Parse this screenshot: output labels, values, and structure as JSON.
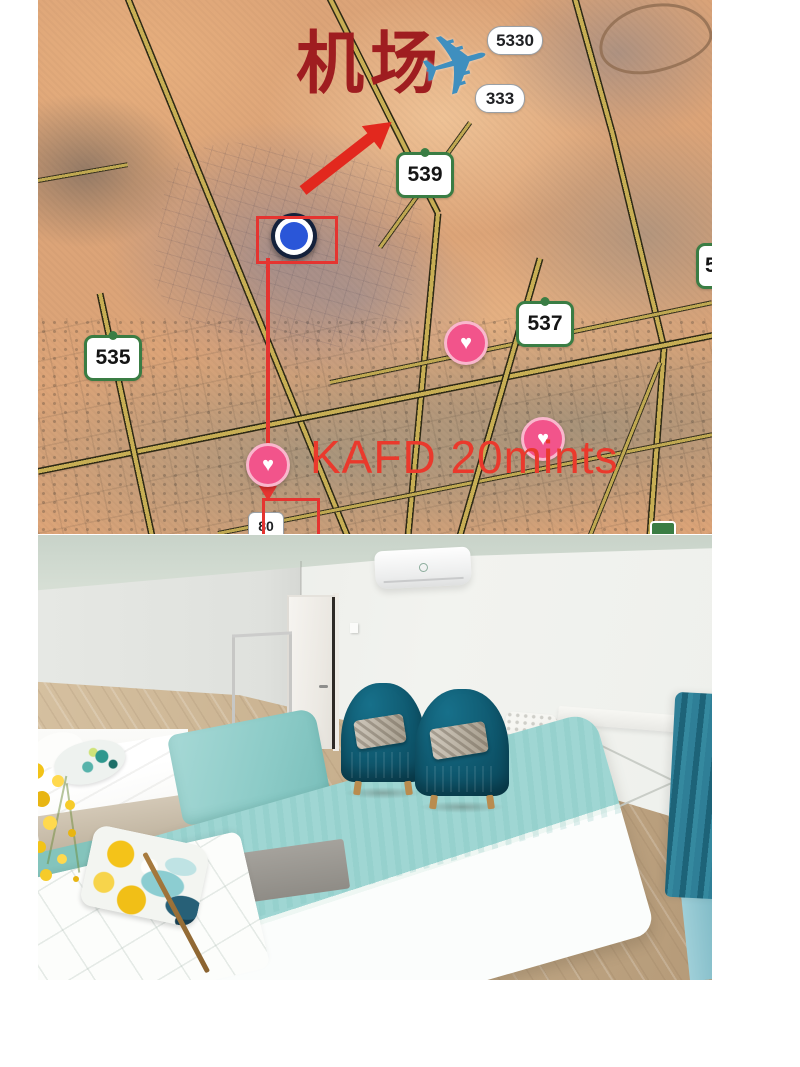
{
  "map": {
    "airport_label": "机场",
    "airplane_glyph": "✈",
    "kafd_label": "KAFD 20mints",
    "heart_glyph": "♥",
    "badges": {
      "pill_5330": "5330",
      "pill_333": "333",
      "shield_539": "539",
      "shield_537": "537",
      "shield_535": "535",
      "shield_partial": "5",
      "pill_80": "80"
    },
    "colors": {
      "annotation_red": "#e2281e",
      "airport_label_red": "#9f1d20",
      "kafd_red": "#ea392c",
      "shield_green": "#3a7d44",
      "pin_pink": "#f2548b",
      "marker_blue": "#2a56d8",
      "road_yellow": "#c7ae54"
    }
  },
  "photo": {
    "colors": {
      "armchair_teal": "#0e566c",
      "blanket_teal": "#9fd6d3",
      "curtain_teal": "#2f7f97",
      "floor_wood": "#c5ad8b",
      "pillow_yellow": "#f4c319"
    }
  }
}
